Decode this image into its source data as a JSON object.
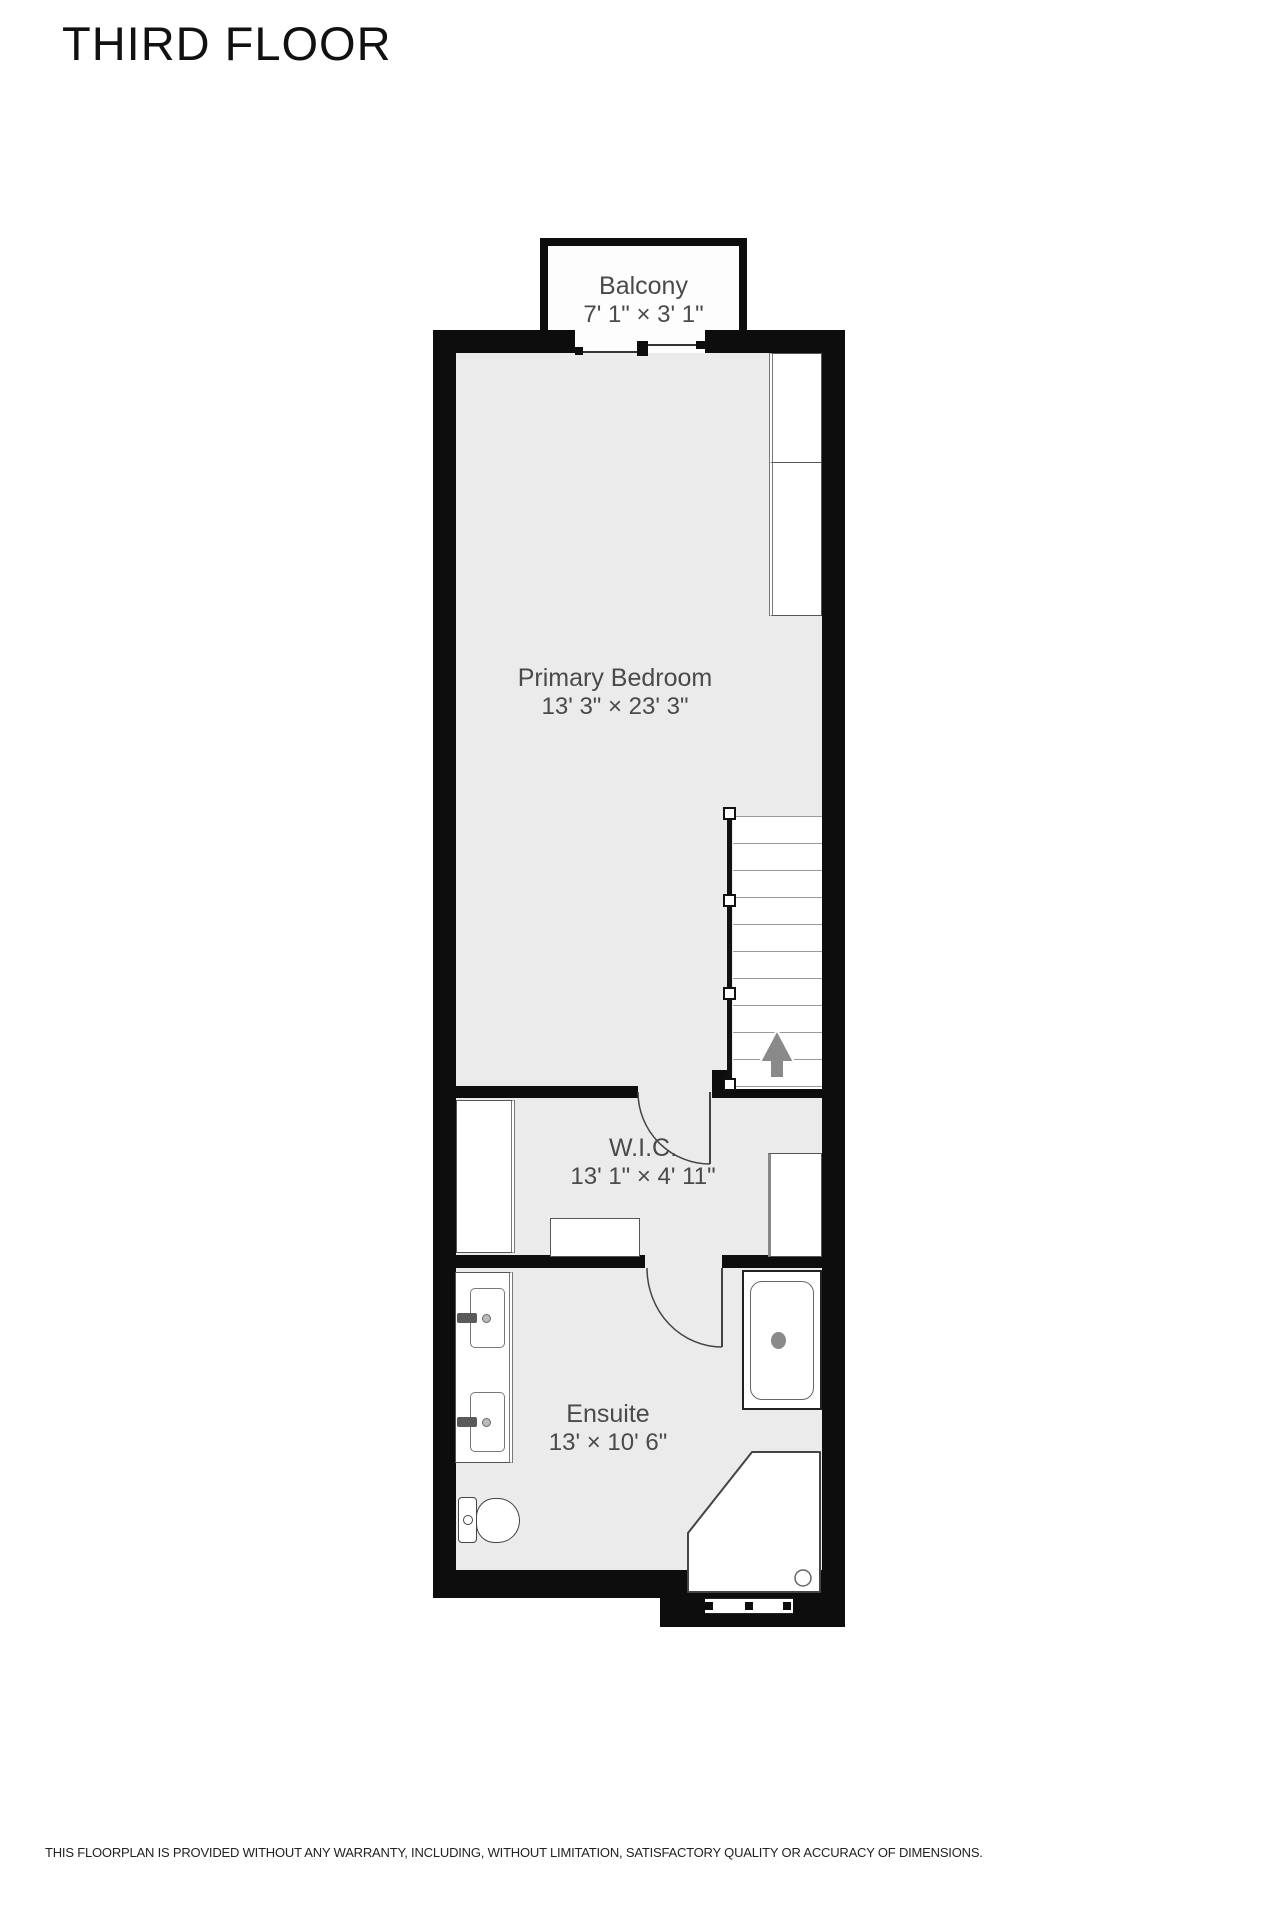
{
  "title": "THIRD FLOOR",
  "disclaimer": "THIS FLOORPLAN IS PROVIDED WITHOUT ANY WARRANTY, INCLUDING, WITHOUT LIMITATION, SATISFACTORY QUALITY OR ACCURACY OF DIMENSIONS.",
  "rooms": [
    {
      "name": "Balcony",
      "dimensions": "7' 1\" × 3' 1\""
    },
    {
      "name": "Primary Bedroom",
      "dimensions": "13' 3\" × 23' 3\""
    },
    {
      "name": "W.I.C.",
      "dimensions": "13' 1\" × 4' 11\""
    },
    {
      "name": "Ensuite",
      "dimensions": "13' × 10' 6\""
    }
  ],
  "fixtures": [
    "closet",
    "stairs",
    "stairs-up-arrow",
    "wardrobe",
    "shelf",
    "vanity-double-sink",
    "toilet",
    "bathtub",
    "corner-shower"
  ],
  "colors": {
    "wall": "#0d0d0d",
    "floor": "#ebebeb",
    "fixture_fill": "#ffffff",
    "label_text": "#4a4a4a",
    "arrow": "#8a8a8a"
  }
}
